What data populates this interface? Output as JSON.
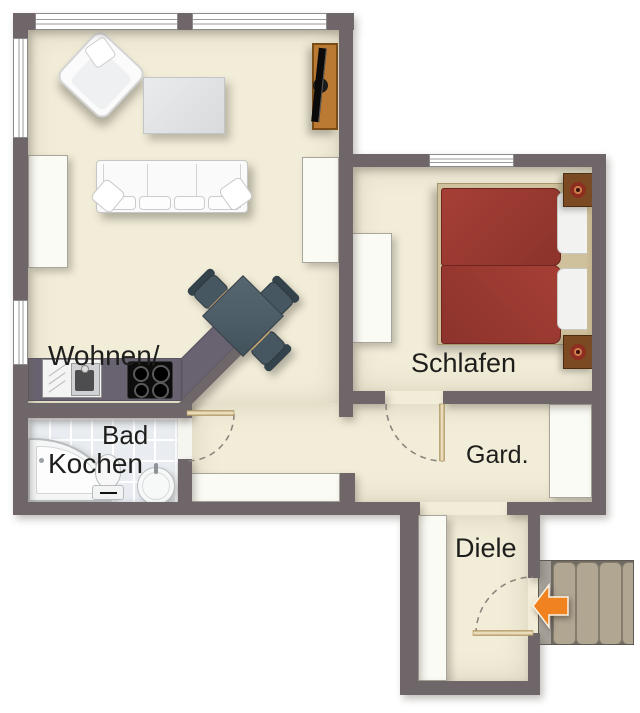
{
  "diagram": {
    "type": "apartment-floor-plan",
    "rooms": {
      "living": {
        "label_line1": "Wohnen/",
        "label_line2": "Kochen"
      },
      "bedroom": {
        "label": "Schlafen"
      },
      "bathroom": {
        "label": "Bad"
      },
      "wardrobe_nook": {
        "label": "Gard."
      },
      "hallway": {
        "label": "Diele"
      }
    },
    "furniture": [
      "armchair",
      "coffee-table",
      "sofa",
      "tv-sideboard",
      "dining-table",
      "dining-chairs",
      "kitchen-counter",
      "kitchen-sink",
      "cooktop",
      "cupboard",
      "corner-bathtub",
      "toilet",
      "washbasin",
      "double-bed",
      "nightstand-lamps",
      "wardrobe",
      "sideboard",
      "hall-closet",
      "entrance-stairs"
    ],
    "entrance_arrow": {
      "icon": "entrance-arrow",
      "direction": "left",
      "color": "#f0831f"
    },
    "colors": {
      "wall": "#6e6669",
      "floor": "#f2edd8",
      "bath_tile": "#e9edf1",
      "bed_cover": "#9c3a31",
      "dining_table": "#4d5e68",
      "stair_tread": "#b1a692",
      "wood": "#bb7a33",
      "door_leaf": "#d6c189",
      "outside": "#ffffff"
    }
  }
}
